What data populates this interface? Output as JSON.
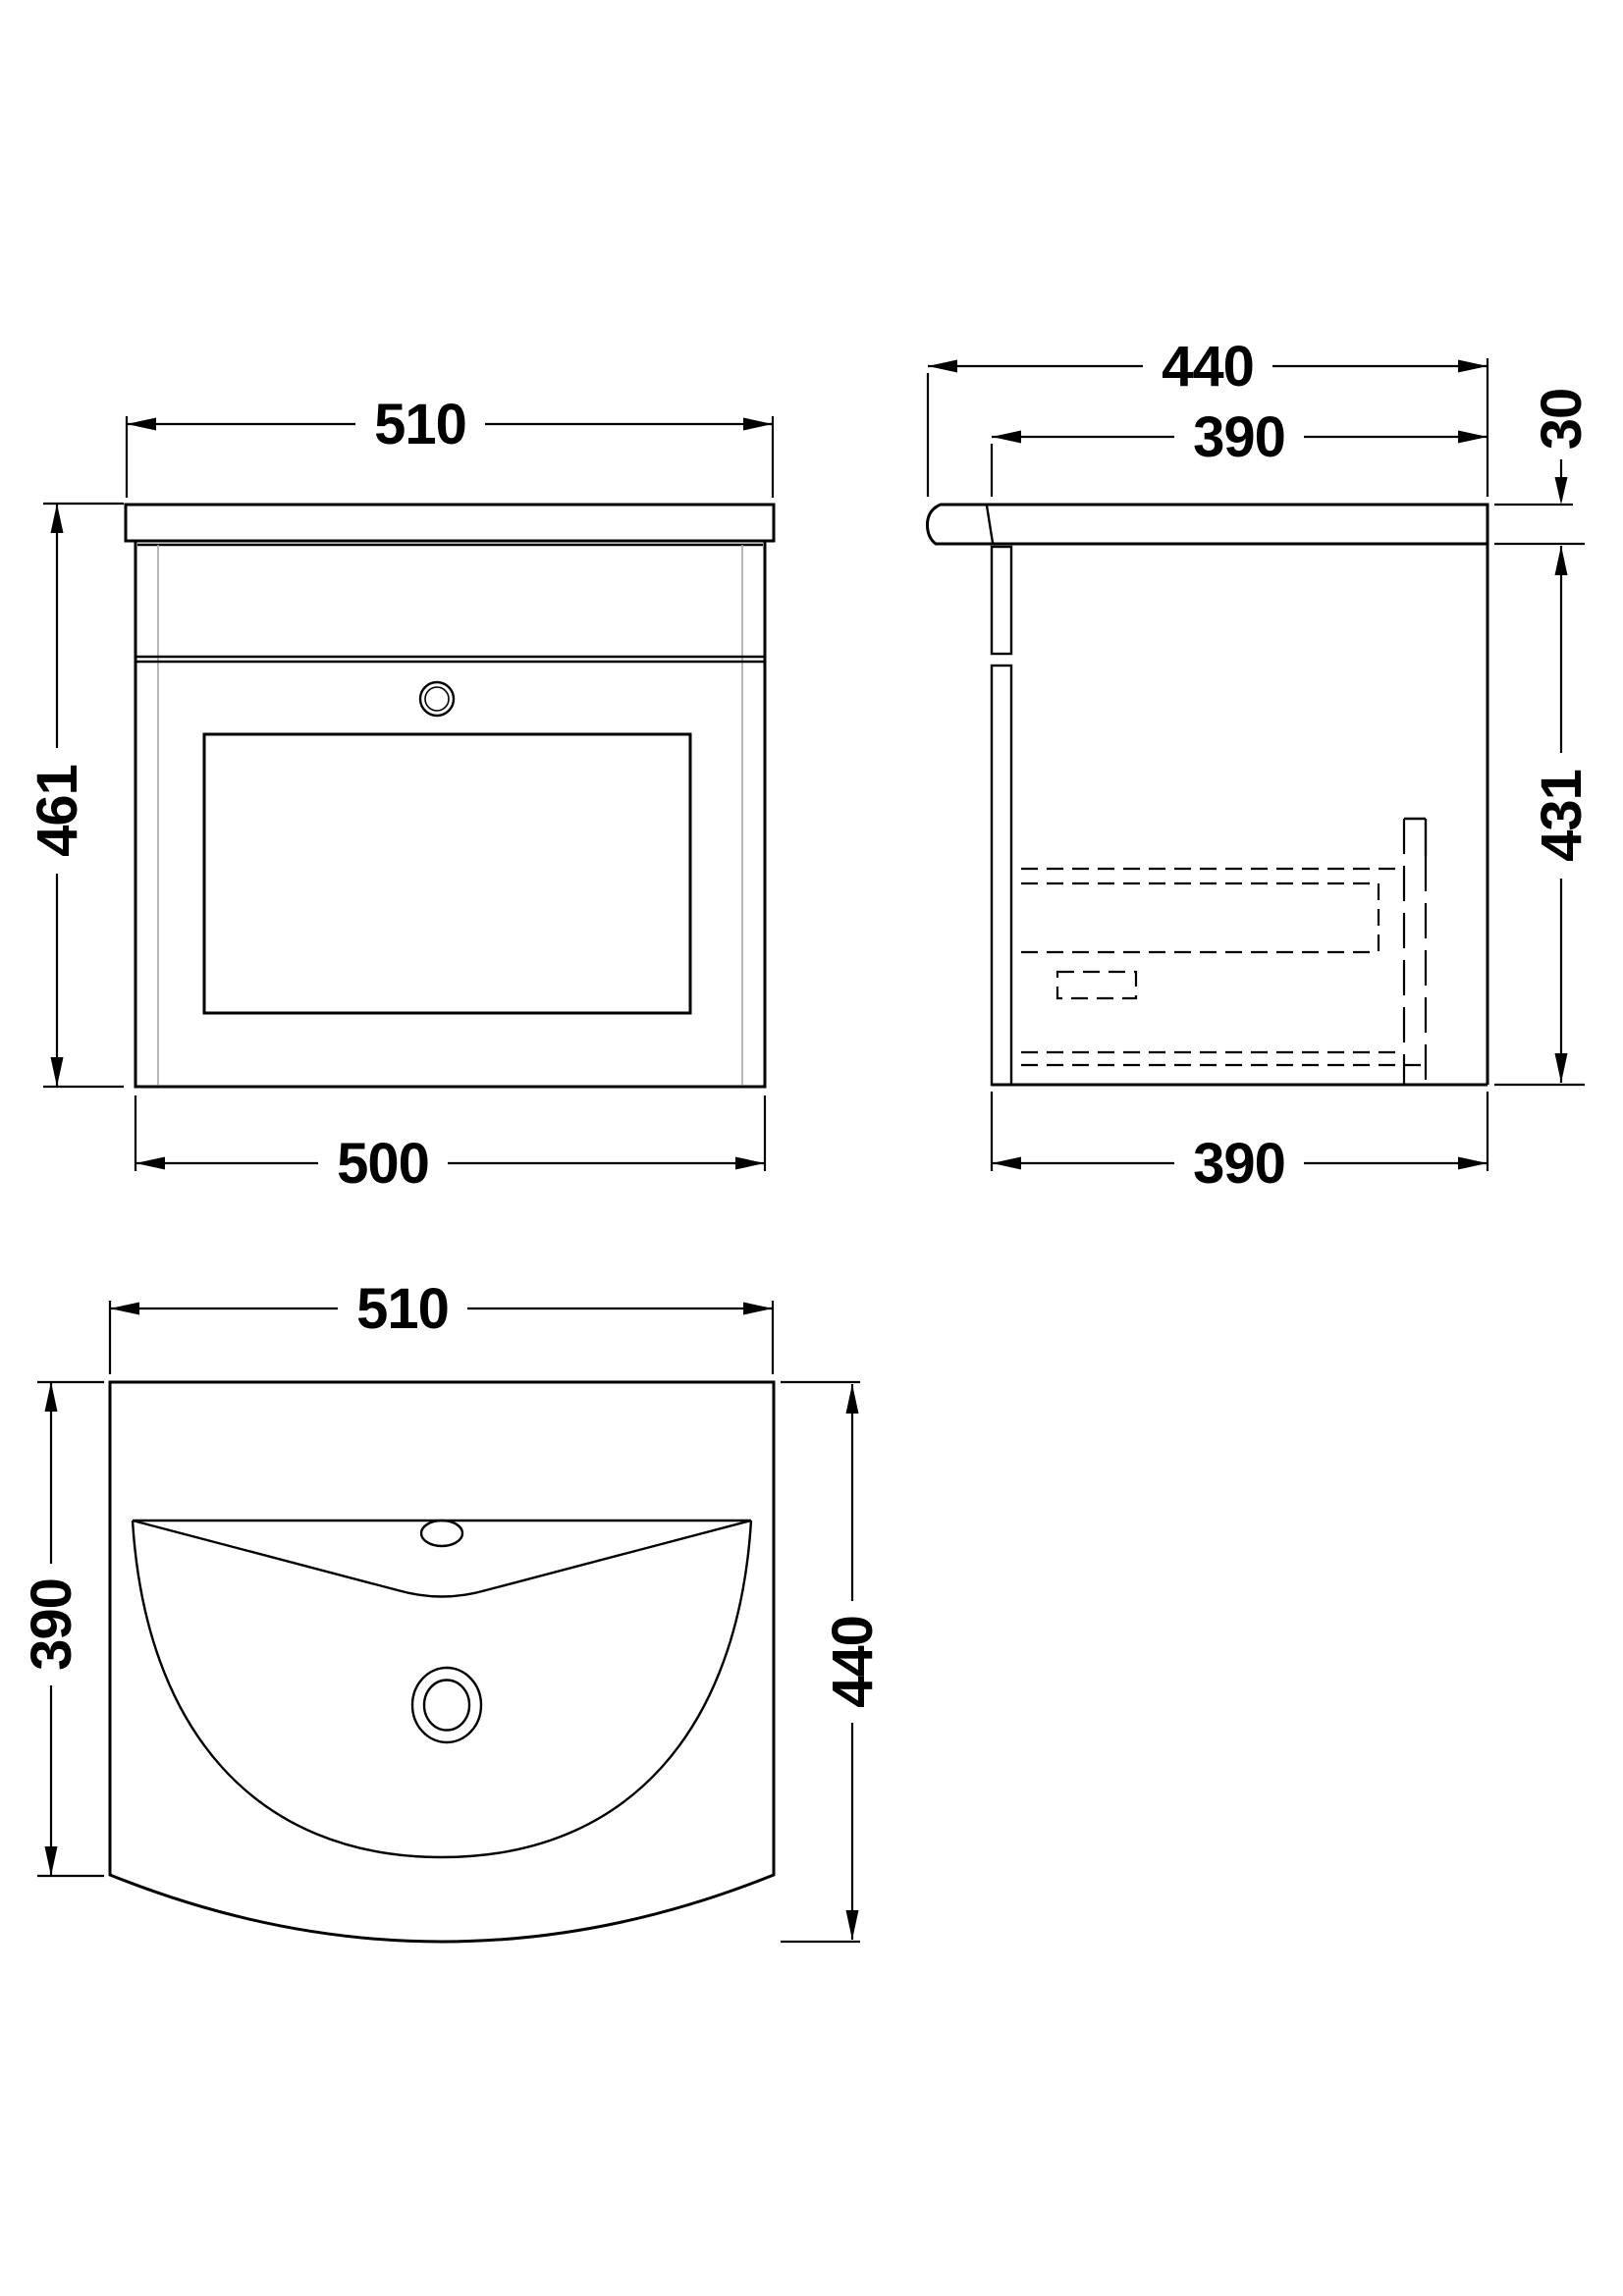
{
  "views": {
    "front": {
      "label_width_top": "510",
      "label_height": "461",
      "label_width_bottom": "500"
    },
    "side": {
      "label_depth_overall": "440",
      "label_depth_inner_top": "390",
      "label_worktop_thickness": "30",
      "label_cabinet_height": "431",
      "label_depth_inner_bottom": "390"
    },
    "plan": {
      "label_width": "510",
      "label_depth_left": "390",
      "label_depth_right": "440"
    }
  },
  "colors": {
    "line": "#000000",
    "secondary_line": "#a6a6a6",
    "background": "#ffffff"
  }
}
